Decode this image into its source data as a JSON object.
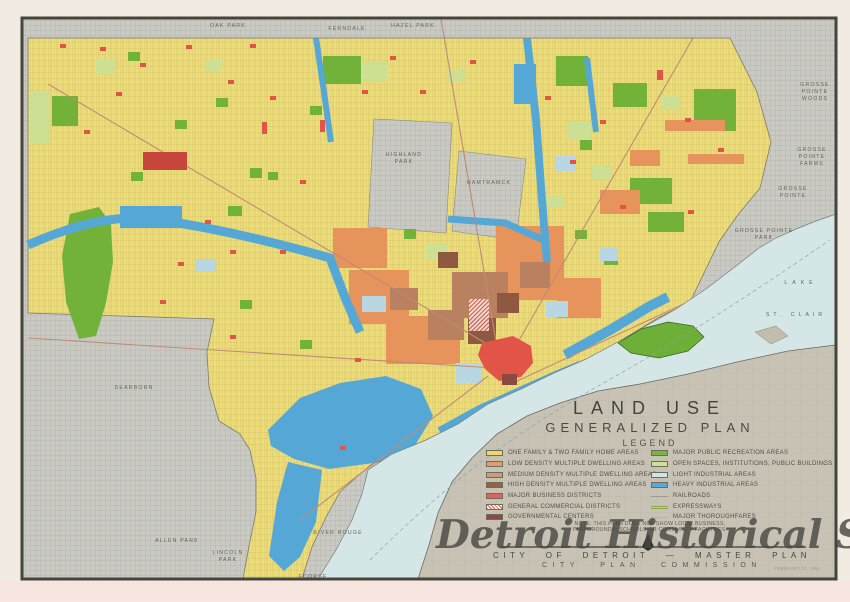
{
  "title": {
    "line1": "LAND USE",
    "line2": "GENERALIZED PLAN",
    "legend_heading": "LEGEND"
  },
  "legend": {
    "left_items": [
      {
        "label": "ONE FAMILY & TWO FAMILY HOME AREAS",
        "type": "fill",
        "color": "#ecd96b"
      },
      {
        "label": "LOW DENSITY MULTIPLE DWELLING AREAS",
        "type": "fill",
        "color": "#e39a6e"
      },
      {
        "label": "MEDIUM DENSITY MULTIPLE DWELLING AREAS",
        "type": "fill",
        "color": "#c79d80"
      },
      {
        "label": "HIGH DENSITY MULTIPLE DWELLING AREAS",
        "type": "fill",
        "color": "#946248"
      },
      {
        "label": "MAJOR BUSINESS DISTRICTS",
        "type": "fill",
        "color": "#e2645b"
      },
      {
        "label": "GENERAL COMMERCIAL DISTRICTS",
        "type": "hatch",
        "color": "#d95f55"
      },
      {
        "label": "GOVERNMENTAL CENTERS",
        "type": "fill",
        "color": "#8a4a42"
      }
    ],
    "right_items": [
      {
        "label": "MAJOR PUBLIC RECREATION AREAS",
        "type": "fill",
        "color": "#79b440"
      },
      {
        "label": "OPEN SPACES, INSTITUTIONS, PUBLIC BUILDINGS",
        "type": "fill",
        "color": "#cde096"
      },
      {
        "label": "LIGHT INDUSTRIAL AREAS",
        "type": "fill",
        "color": "#cfe3e8"
      },
      {
        "label": "HEAVY INDUSTRIAL AREAS",
        "type": "fill",
        "color": "#57a9d9"
      },
      {
        "label": "RAILROADS",
        "type": "line",
        "color": "#9a9a8e"
      },
      {
        "label": "EXPRESSWAYS",
        "type": "doubleline",
        "color": "#8aa84a"
      },
      {
        "label": "MAJOR THOROUGHFARES",
        "type": "line",
        "color": "#b3b3a6"
      }
    ],
    "note_line1": "NOTE: THIS PLAN DOES NOT SHOW LOCAL BUSINESS,",
    "note_line2": "PLAYGROUNDS, SCHOOLS OR COMMUNITY FACILITIES."
  },
  "footer": {
    "line1": "CITY OF DETROIT — MASTER PLAN",
    "line2": "CITY PLAN COMMISSION",
    "date": "FEBRUARY 13, 1951"
  },
  "watermark": "Detroit Historical Society",
  "map_labels": [
    "OAK PARK",
    "FERNDALE",
    "HAZEL PARK",
    "GROSSE",
    "POINTE",
    "WOODS",
    "GROSSE",
    "POINTE",
    "FARMS",
    "GROSSE",
    "POINTE",
    "GROSSE POINTE",
    "PARK",
    "LAKE",
    "ST. CLAIR",
    "HIGHLAND",
    "PARK",
    "HAMTRAMCK",
    "DEARBORN",
    "ALLEN PARK",
    "LINCOLN",
    "PARK",
    "RIVER ROUGE",
    "ECORSE"
  ]
}
